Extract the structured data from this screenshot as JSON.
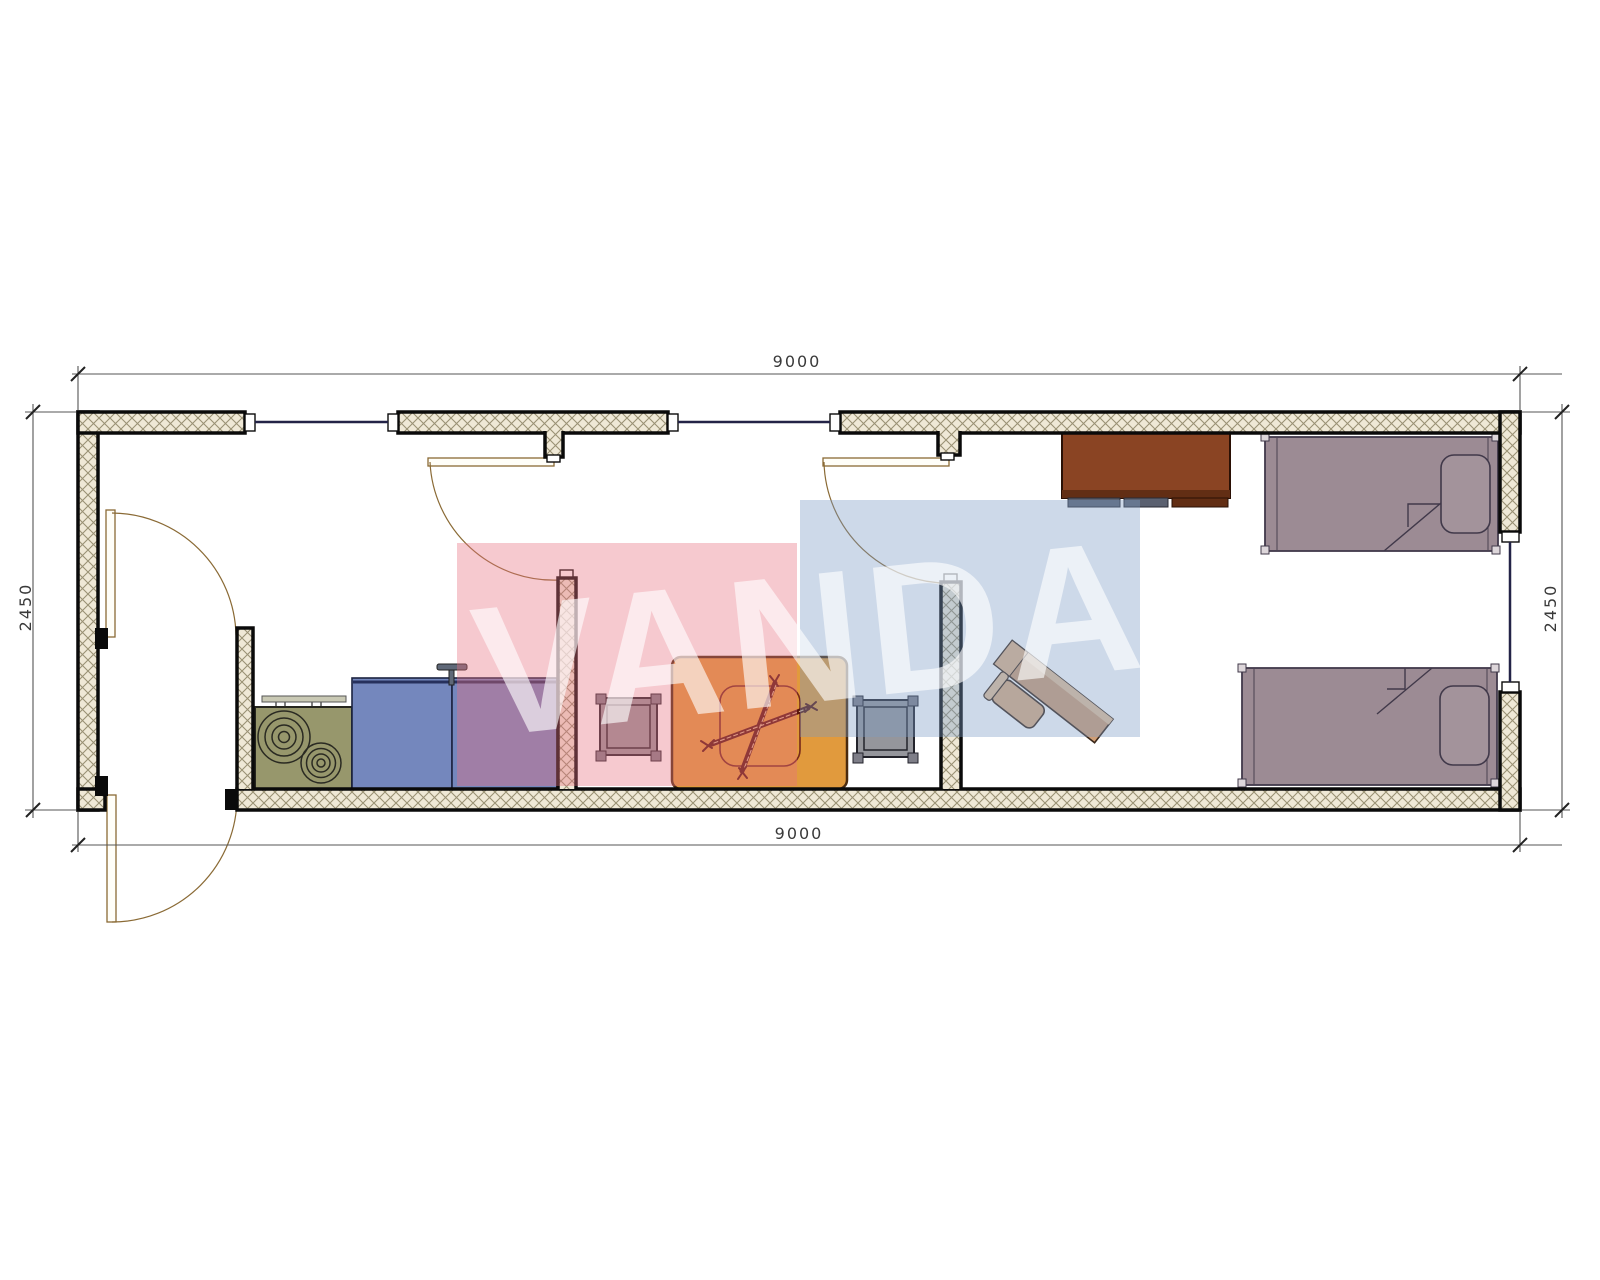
{
  "drawing": {
    "type": "floor-plan",
    "description": "container house plan with vestibule, kitchen-dining area and bedroom"
  },
  "dimensions": {
    "top_width": "9000",
    "bottom_width": "9000",
    "left_height": "2450",
    "right_height": "2450"
  },
  "watermark": {
    "text": "VANDA",
    "pink": "#e77181",
    "blue": "#7b9bc5",
    "letter_color": "rgba(255,255,255,0.62)"
  },
  "colors": {
    "wall_fill": "#efe8d6",
    "wall_hatch": "#9a9174",
    "wall_outline": "#0a0a0a",
    "window_line": "#232347",
    "door_line": "#8a6a35",
    "door_leaf": "#fffef8",
    "stove": "#97976c",
    "burner_ring": "#2a2a22",
    "cabinet": "#7487bd",
    "cabinet_edge": "#26305c",
    "faucet": "#5f6878",
    "table": "#e19a3d",
    "table_inner": "#76281a",
    "cutlery": "#5a150c",
    "stool": "#8f9097",
    "stool_leg": "#7e7e88",
    "wardrobe": "#8a4423",
    "wardrobe_base": "#622e14",
    "wardrobe_foot": "#5b6170",
    "desk": "#cf9e76",
    "desk_light": "#e6c29b",
    "chair": "#dcae84",
    "bed": "#9c8b94",
    "bed_outline": "#41394a",
    "pillow": "#a3939b",
    "bed_corner": "#ddd6da",
    "dim_line": "#555555",
    "dim_text": "#3a3a3a"
  },
  "furniture": [
    {
      "name": "stove"
    },
    {
      "name": "kitchen-cabinet"
    },
    {
      "name": "sink-cabinet"
    },
    {
      "name": "dining-table"
    },
    {
      "name": "stool-left"
    },
    {
      "name": "stool-right"
    },
    {
      "name": "wardrobe"
    },
    {
      "name": "desk-with-chair"
    },
    {
      "name": "bed-top"
    },
    {
      "name": "bed-bottom"
    }
  ]
}
